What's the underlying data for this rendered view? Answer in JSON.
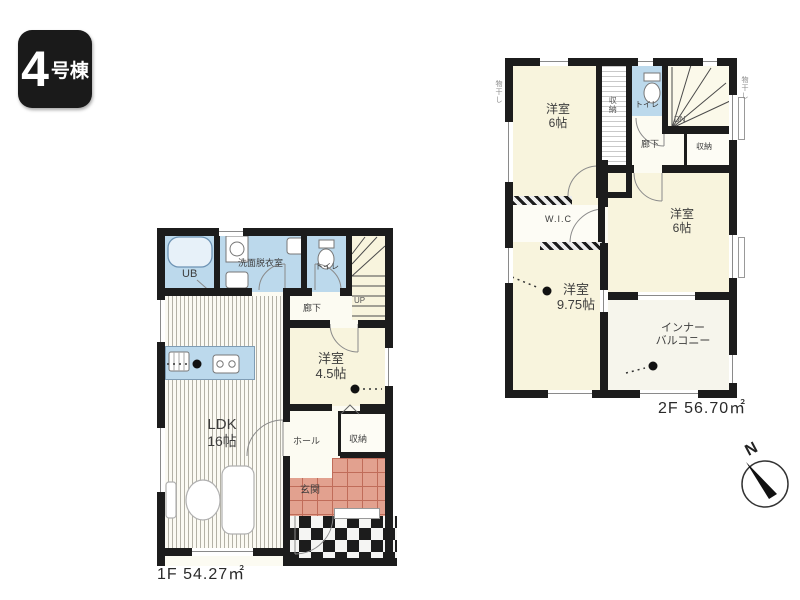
{
  "badge": {
    "number": "4",
    "suffix": "号棟"
  },
  "floor1": {
    "area": "1F 54.27㎡",
    "labels": {
      "ub": "UB",
      "washroom": "洗面脱衣室",
      "toilet": "トイレ",
      "corridor": "廊下",
      "up": "UP",
      "room_name": "洋室",
      "room_size": "4.5帖",
      "ldk_name": "LDK",
      "ldk_size": "16帖",
      "hall": "ホール",
      "storage": "収納",
      "entrance": "玄関"
    }
  },
  "floor2": {
    "area": "2F 56.70㎡",
    "labels": {
      "room_a_name": "洋室",
      "room_a_size": "6帖",
      "closet_top": "収納",
      "toilet": "トイレ",
      "dn": "DN",
      "corridor": "廊下",
      "closet_right": "収納",
      "wic": "W.I.C",
      "room_b_name": "洋室",
      "room_b_size": "9.75帖",
      "room_c_name": "洋室",
      "room_c_size": "6帖",
      "balcony_line1": "インナー",
      "balcony_line2": "バルコニー",
      "annotation_left": "物干し",
      "annotation_right": "物干し"
    }
  },
  "compass": {
    "north": "N"
  },
  "colors": {
    "wall": "#1c1c1c",
    "wet_area": "#bcd9ec",
    "room_cream": "#f8f4dd",
    "entrance_tile": "#e2a18f",
    "badge_bg": "#1a1a1a"
  }
}
